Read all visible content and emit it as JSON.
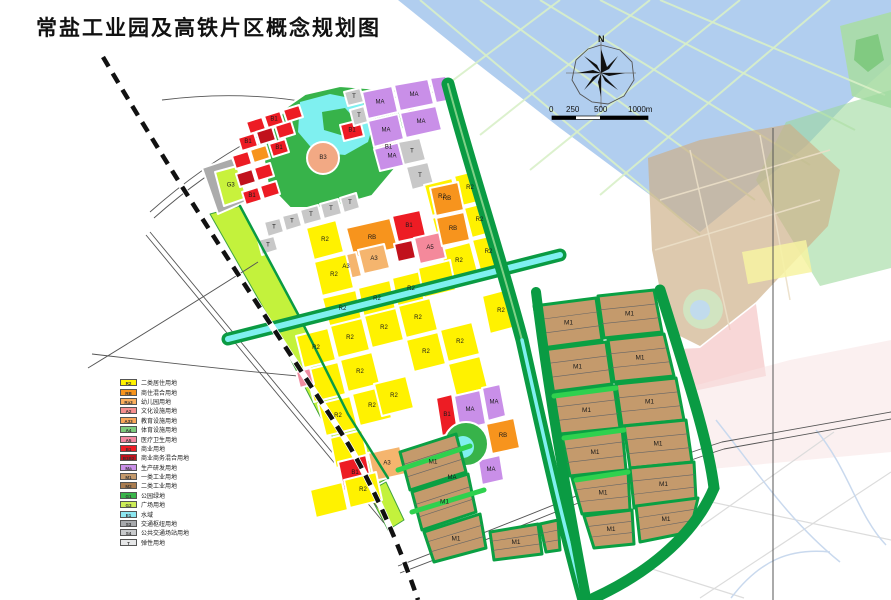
{
  "title": "常盐工业园及高铁片区概念规划图",
  "compass": {
    "label": "N"
  },
  "scale_bar": {
    "labels": [
      "0",
      "250",
      "500",
      "1000m"
    ]
  },
  "legend": {
    "items": [
      {
        "code": "R2",
        "color": "#FFF200",
        "label": "二类居住用地"
      },
      {
        "code": "RB",
        "color": "#F7941D",
        "label": "商住混合用地"
      },
      {
        "code": "Ra3",
        "color": "#FBAF5D",
        "label": "幼儿园用地"
      },
      {
        "code": "A2",
        "color": "#F68E8E",
        "label": "文化设施用地"
      },
      {
        "code": "A33",
        "color": "#F9A65A",
        "label": "教育设施用地"
      },
      {
        "code": "A4",
        "color": "#7CCB7C",
        "label": "体育设施用地"
      },
      {
        "code": "A5",
        "color": "#F287A0",
        "label": "医疗卫生用地"
      },
      {
        "code": "B1",
        "color": "#ED1C24",
        "label": "商业用地"
      },
      {
        "code": "B1B2",
        "color": "#C1121C",
        "label": "商业商务混合用地"
      },
      {
        "code": "Ma",
        "color": "#C98FE8",
        "label": "生产研发用地"
      },
      {
        "code": "M1",
        "color": "#C49A6C",
        "label": "一类工业用地"
      },
      {
        "code": "M2",
        "color": "#A97C50",
        "label": "二类工业用地"
      },
      {
        "code": "G1",
        "color": "#39B54A",
        "label": "公园绿地"
      },
      {
        "code": "G3",
        "color": "#CDED57",
        "label": "广场用地"
      },
      {
        "code": "E1",
        "color": "#8CE6F0",
        "label": "水域"
      },
      {
        "code": "S3",
        "color": "#A7A9AC",
        "label": "交通枢纽用地"
      },
      {
        "code": "S4",
        "color": "#C8CACC",
        "label": "公共交通场站用地"
      },
      {
        "code": "T",
        "color": "#E6E7E8",
        "label": "弹性用地"
      }
    ]
  },
  "map": {
    "context": [
      {
        "p": "398,0 891,0 891,64 846,104 806,146 700,232 560,128 470,58",
        "f": "#A3C6EC",
        "o": 0.85
      },
      {
        "p": "840,26 891,12 891,108 852,96",
        "f": "#AADDA5",
        "o": 0.9
      },
      {
        "p": "856,40 878,34 884,60 868,72 854,60",
        "f": "#7CC87C",
        "o": 0.9,
        "s": "none"
      },
      {
        "d": "M420,0 L700,235",
        "st": "#D8EFC8",
        "w": 2,
        "o": 0.9
      },
      {
        "d": "M480,0 L755,200",
        "st": "#D8EFC8",
        "w": 2,
        "o": 0.9
      },
      {
        "d": "M540,0 L810,165",
        "st": "#D8EFC8",
        "w": 2,
        "o": 0.9
      },
      {
        "d": "M600,0 L855,130",
        "st": "#D8EFC8",
        "w": 2,
        "o": 0.9
      },
      {
        "d": "M660,0 L885,95",
        "st": "#D8EFC8",
        "w": 2,
        "o": 0.9
      },
      {
        "d": "M560,0 L440,90",
        "st": "#D8EFC8",
        "w": 2,
        "o": 0.9
      },
      {
        "d": "M650,0 L480,135",
        "st": "#D8EFC8",
        "w": 2,
        "o": 0.9
      },
      {
        "d": "M740,0 L530,170",
        "st": "#D8EFC8",
        "w": 2,
        "o": 0.9
      },
      {
        "d": "M830,0 L600,195",
        "st": "#D8EFC8",
        "w": 2,
        "o": 0.9
      },
      {
        "p": "786,122 891,90 891,268 820,286 756,180",
        "f": "#9CD89C",
        "o": 0.6
      },
      {
        "p": "648,158 700,140 790,124 840,170 828,226 756,302 700,346 668,330 652,250",
        "f": "#CDAF87",
        "o": 0.68
      },
      {
        "d": "M660,200 L830,150",
        "st": "#EBDFC8",
        "w": 1.5,
        "o": 0.9
      },
      {
        "d": "M655,250 L820,200",
        "st": "#EBDFC8",
        "w": 1.5,
        "o": 0.9
      },
      {
        "d": "M690,150 L730,330",
        "st": "#EBDFC8",
        "w": 1.5,
        "o": 0.9
      },
      {
        "d": "M760,135 L790,300",
        "st": "#EBDFC8",
        "w": 1.5,
        "o": 0.9
      },
      {
        "p": "656,350 700,348 756,304 766,376 660,398",
        "f": "#F3BCBC",
        "o": 0.6
      },
      {
        "c": [
          703,
          309,
          20
        ],
        "f": "#CFE9C4",
        "o": 0.85
      },
      {
        "c": [
          700,
          310,
          10
        ],
        "f": "#BFD9F2",
        "o": 0.9
      },
      {
        "p": "742,252 806,240 812,272 748,284",
        "f": "#F7F3A2",
        "o": 0.85
      },
      {
        "p": "656,396 790,360 891,340 891,452 700,470",
        "f": "#F8E4E4",
        "o": 0.55
      },
      {
        "d": "M560,470 L891,540",
        "st": "#DCDCDC",
        "w": 1.2
      },
      {
        "d": "M600,598 L834,432",
        "st": "#DCDCDC",
        "w": 1.2
      },
      {
        "d": "M700,598 L891,472",
        "st": "#DCDCDC",
        "w": 1.2
      },
      {
        "d": "M560,540 L744,598",
        "st": "#DCDCDC",
        "w": 1.2
      },
      {
        "d": "M716,420 C756,470 788,520 840,562",
        "st": "#C9D9EE",
        "w": 1.5
      },
      {
        "d": "M816,430 C848,468 858,516 886,545",
        "st": "#C9D9EE",
        "w": 1.5
      },
      {
        "d": "M731,598 C760,560 790,548 830,552",
        "st": "#C9D9EE",
        "w": 1.5
      },
      {
        "d": "M773,128 L773,600",
        "st": "#555",
        "w": 1
      }
    ],
    "base": [
      {
        "p": "210,214 244,148 286,96 344,82 452,80 478,180 508,300 660,288 690,380 714,480 700,530 640,572 590,600 396,600 350,466 298,338 252,260",
        "f": "#FFFFFF"
      },
      {
        "p": "210,214 240,206 300,318 348,414 388,478 366,490 322,420 268,316",
        "f": "#C3F23C",
        "s": "#3FA33F"
      },
      {
        "p": "368,492 386,482 404,520 388,530",
        "f": "#C3F23C",
        "s": "#3FA33F"
      }
    ],
    "roads_outside": [
      {
        "d": "M150,212 C240,132 330,96 432,86"
      },
      {
        "d": "M154,218 C244,138 334,102 434,92"
      },
      {
        "d": "M162,100 C240,90 310,98 372,118"
      },
      {
        "d": "M88,368 C150,330 205,296 258,262"
      },
      {
        "d": "M150,232 L388,520"
      },
      {
        "d": "M146,235 L384,523"
      },
      {
        "d": "M92,354 C160,362 230,370 298,376"
      },
      {
        "d": "M398,566 C520,520 640,468 722,442 L891,412"
      },
      {
        "d": "M400,573 C522,527 642,475 724,449 L891,419"
      }
    ],
    "zones": [
      {
        "p": "262,148 285,108 305,94 340,86 392,90 404,125 398,165 372,196 330,208 290,208 268,185",
        "f": "#37B34A"
      },
      {
        "p": "300,102 330,94 360,100 375,118 368,142 345,155 315,152 298,132",
        "f": "#7FF0F0",
        "s": "none"
      },
      {
        "p": "322,112 345,108 358,122 344,136 324,130",
        "f": "#37B34A",
        "s": "none"
      },
      {
        "p": "202,168 232,158 250,200 218,214",
        "f": "#ABABAB"
      },
      {
        "p": "215,172 237,166 247,198 224,206",
        "f": "#C8F23C",
        "l": "G3"
      },
      {
        "p": "246,122 262,117 266,129 250,134",
        "f": "#ED1C24"
      },
      {
        "p": "264,116 280,111 284,123 268,128",
        "f": "#ED1C24",
        "l": "B1"
      },
      {
        "p": "283,110 299,105 303,117 287,122",
        "f": "#ED1C24"
      },
      {
        "p": "238,138 254,133 258,146 242,151",
        "f": "#ED1C24",
        "l": "B1"
      },
      {
        "p": "256,132 272,127 276,140 260,145",
        "f": "#C1121C"
      },
      {
        "p": "275,126 291,121 295,134 279,139",
        "f": "#ED1C24"
      },
      {
        "p": "232,156 248,151 252,164 236,169",
        "f": "#ED1C24"
      },
      {
        "p": "250,150 266,145 270,158 254,163",
        "f": "#F7941D"
      },
      {
        "p": "269,144 285,139 289,152 273,157",
        "f": "#ED1C24",
        "l": "B1"
      },
      {
        "p": "236,174 252,169 256,182 240,187",
        "f": "#C1121C"
      },
      {
        "p": "254,168 270,163 274,176 258,181",
        "f": "#ED1C24"
      },
      {
        "p": "242,192 258,187 262,200 246,205",
        "f": "#ED1C24",
        "l": "B1"
      },
      {
        "p": "260,186 276,181 280,194 264,199",
        "f": "#ED1C24"
      },
      {
        "p": "340,125 360,120 364,136 344,141",
        "f": "#ED1C24",
        "l": "B1"
      },
      {
        "p": "404,97 420,93 424,107 408,112",
        "f": "#ED1C24"
      },
      {
        "p": "376,140 396,135 401,155 381,160",
        "f": "#ED1C24",
        "l": "B1"
      },
      {
        "p": "362,92 392,86 398,112 368,119",
        "f": "#C98FE8",
        "l": "MA"
      },
      {
        "p": "394,85 428,79 434,104 400,111",
        "f": "#C98FE8",
        "l": "MA"
      },
      {
        "p": "368,121 398,114 404,139 374,147",
        "f": "#C98FE8",
        "l": "MA"
      },
      {
        "p": "400,113 436,106 442,130 406,138",
        "f": "#C98FE8",
        "l": "MA"
      },
      {
        "p": "430,78 446,76 452,100 436,103",
        "f": "#C98FE8"
      },
      {
        "p": "374,149 404,141 410,164 380,171",
        "f": "#C98FE8",
        "l": "MA"
      },
      {
        "p": "344,92 360,88 364,102 348,106",
        "f": "#C8C8C8",
        "l": "T"
      },
      {
        "p": "350,110 364,106 368,122 354,126",
        "f": "#C8C8C8",
        "l": "T"
      },
      {
        "p": "398,142 420,138 426,160 404,165",
        "f": "#C8C8C8",
        "l": "T"
      },
      {
        "p": "406,167 428,162 434,184 412,190",
        "f": "#C8C8C8",
        "l": "T"
      },
      {
        "p": "300,210 318,205 322,220 304,225",
        "f": "#C8C8C8",
        "l": "T"
      },
      {
        "p": "320,204 338,199 342,214 324,219",
        "f": "#C8C8C8",
        "l": "T"
      },
      {
        "p": "282,216 298,212 302,226 286,231",
        "f": "#C8C8C8",
        "l": "T"
      },
      {
        "p": "264,222 280,218 284,232 268,237",
        "f": "#C8C8C8",
        "l": "T"
      },
      {
        "p": "340,198 356,193 360,208 344,213",
        "f": "#C8C8C8",
        "l": "T"
      },
      {
        "p": "258,240 274,236 278,250 262,255",
        "f": "#C8C8C8",
        "l": "T"
      },
      {
        "c": [
          323,
          158,
          16
        ],
        "f": "#F2A984",
        "l": "B3"
      },
      {
        "p": "424,185 452,178 460,208 432,216",
        "f": "#FFF200",
        "l": "R2"
      },
      {
        "p": "454,176 478,170 486,200 462,206",
        "f": "#FFF200",
        "l": "R2"
      },
      {
        "p": "432,218 462,210 470,240 440,248",
        "f": "#FFF200"
      },
      {
        "p": "464,208 488,202 494,232 472,238",
        "f": "#FFF200",
        "l": "R2"
      },
      {
        "p": "440,250 470,242 478,272 448,280",
        "f": "#FFF200",
        "l": "R2"
      },
      {
        "p": "472,240 498,234 504,264 480,270",
        "f": "#FFF200",
        "l": "R2"
      },
      {
        "p": "482,296 512,288 520,326 490,334",
        "f": "#FFF200",
        "l": "R2"
      },
      {
        "p": "306,228 336,220 344,252 314,260",
        "f": "#FFF200",
        "l": "R2"
      },
      {
        "p": "346,228 390,218 398,248 354,258",
        "f": "#F7941D",
        "l": "RB"
      },
      {
        "p": "330,258 356,252 362,276 336,282",
        "f": "#F5B56E",
        "l": "A3"
      },
      {
        "p": "358,250 384,244 390,268 364,274",
        "f": "#F5B56E",
        "l": "A3"
      },
      {
        "p": "392,216 420,210 426,236 398,242",
        "f": "#ED1C24",
        "l": "B1"
      },
      {
        "p": "394,244 412,240 416,258 398,262",
        "f": "#C1121C"
      },
      {
        "p": "414,238 440,232 446,258 420,264",
        "f": "#F4899B",
        "l": "A5"
      },
      {
        "p": "430,188 458,182 464,210 436,216",
        "f": "#F7941D",
        "l": "RB"
      },
      {
        "p": "436,218 464,212 470,240 442,246",
        "f": "#F7941D",
        "l": "RB"
      },
      {
        "p": "314,262 346,254 354,288 322,296",
        "f": "#FFF200",
        "l": "R2"
      },
      {
        "p": "322,298 356,290 362,320 330,328",
        "f": "#FFF200",
        "l": "R2"
      },
      {
        "p": "358,288 390,280 396,310 364,318",
        "f": "#FFF200",
        "l": "R2"
      },
      {
        "p": "392,278 424,270 430,300 398,308",
        "f": "#FFF200",
        "l": "R2"
      },
      {
        "p": "418,268 450,260 456,290 424,298",
        "f": "#FFF200"
      },
      {
        "p": "296,336 328,328 336,360 304,368",
        "f": "#FFF200",
        "l": "R2"
      },
      {
        "p": "330,326 362,318 370,350 338,358",
        "f": "#FFF200",
        "l": "R2"
      },
      {
        "p": "306,370 338,362 346,394 314,402",
        "f": "#FFF200"
      },
      {
        "p": "340,360 372,352 380,384 348,392",
        "f": "#FFF200",
        "l": "R2"
      },
      {
        "p": "318,404 350,396 358,428 326,436",
        "f": "#FFF200",
        "l": "R2"
      },
      {
        "p": "352,394 384,386 392,418 360,426",
        "f": "#FFF200",
        "l": "R2"
      },
      {
        "p": "330,438 362,430 368,460 336,468",
        "f": "#FFF200"
      },
      {
        "p": "364,316 396,308 404,340 372,348",
        "f": "#FFF200",
        "l": "R2"
      },
      {
        "p": "398,306 430,298 438,330 406,338",
        "f": "#FFF200",
        "l": "R2"
      },
      {
        "p": "406,340 438,332 446,364 414,372",
        "f": "#FFF200",
        "l": "R2"
      },
      {
        "p": "440,330 472,322 480,354 448,362",
        "f": "#FFF200",
        "l": "R2"
      },
      {
        "p": "448,364 480,356 488,388 456,396",
        "f": "#FFF200"
      },
      {
        "p": "296,372 310,368 314,384 300,388",
        "f": "#F08CA0"
      },
      {
        "p": "374,384 406,376 414,408 382,416",
        "f": "#FFF200",
        "l": "R2"
      },
      {
        "p": "338,462 366,455 372,484 344,491",
        "f": "#ED1C24",
        "l": "B1"
      },
      {
        "p": "368,453 400,446 406,474 374,481",
        "f": "#F5B56E",
        "l": "A3"
      },
      {
        "p": "310,490 342,482 348,510 316,518",
        "f": "#FFF200"
      },
      {
        "p": "344,480 376,472 382,500 350,508",
        "f": "#FFF200",
        "l": "R2"
      },
      {
        "p": "436,398 452,394 458,432 442,436",
        "f": "#ED1C24",
        "l": "B1"
      },
      {
        "p": "454,396 480,390 486,424 460,430",
        "f": "#C98FE8",
        "l": "MA"
      },
      {
        "p": "482,388 500,384 506,416 488,421",
        "f": "#C98FE8",
        "l": "MA"
      },
      {
        "p": "486,424 514,418 520,448 492,454",
        "f": "#F7941D",
        "l": "RB"
      },
      {
        "p": "438,468 462,462 466,488 442,493",
        "f": "#C98FE8",
        "l": "MA"
      },
      {
        "p": "478,460 500,455 504,480 482,485",
        "f": "#C98FE8",
        "l": "MA"
      },
      {
        "c": [
          466,
          444,
          22
        ],
        "f": "#37B34A"
      },
      {
        "c": [
          463,
          447,
          11
        ],
        "f": "#7FF0F0",
        "s": "none"
      },
      {
        "p": "400,452 456,434 466,472 410,490",
        "f": "#C49A6C",
        "l": "M1",
        "h": 1,
        "sw": 3,
        "s": "#0AA043"
      },
      {
        "p": "412,492 468,474 476,512 422,530",
        "f": "#C49A6C",
        "l": "M1",
        "h": 1,
        "sw": 3,
        "s": "#0AA043"
      },
      {
        "p": "424,532 480,514 486,548 434,562",
        "f": "#C49A6C",
        "l": "M1",
        "h": 1,
        "sw": 3,
        "s": "#0AA043"
      },
      {
        "p": "490,532 538,524 542,554 494,560",
        "f": "#C49A6C",
        "l": "M1",
        "h": 1,
        "sw": 3,
        "s": "#0AA043"
      },
      {
        "p": "540,524 558,520 560,550 546,552",
        "f": "#C49A6C",
        "h": 1,
        "sw": 3,
        "s": "#0AA043"
      },
      {
        "p": "534,306 596,298 602,340 542,348",
        "f": "#C49A6C",
        "l": "M1",
        "h": 1,
        "sw": 3,
        "s": "#0AA043"
      },
      {
        "p": "598,296 654,290 662,332 604,338",
        "f": "#C49A6C",
        "l": "M1",
        "h": 1,
        "sw": 3,
        "s": "#0AA043"
      },
      {
        "p": "542,350 606,342 612,384 550,392",
        "f": "#C49A6C",
        "l": "M1",
        "h": 1,
        "sw": 3,
        "s": "#0AA043"
      },
      {
        "p": "608,340 664,334 674,376 614,382",
        "f": "#C49A6C",
        "l": "M1",
        "h": 1,
        "sw": 3,
        "s": "#0AA043"
      },
      {
        "p": "552,394 614,386 620,428 560,434",
        "f": "#C49A6C",
        "l": "M1",
        "h": 1,
        "sw": 3,
        "s": "#0AA043"
      },
      {
        "p": "616,384 676,378 684,420 622,426",
        "f": "#C49A6C",
        "l": "M1",
        "h": 1,
        "sw": 3,
        "s": "#0AA043"
      },
      {
        "p": "562,436 622,428 626,470 570,476",
        "f": "#C49A6C",
        "l": "M1",
        "h": 1,
        "sw": 3,
        "s": "#0AA043"
      },
      {
        "p": "624,426 686,420 692,462 630,468",
        "f": "#C49A6C",
        "l": "M1",
        "h": 1,
        "sw": 3,
        "s": "#0AA043"
      },
      {
        "p": "572,478 628,470 630,510 582,514",
        "f": "#C49A6C",
        "l": "M1",
        "h": 1,
        "sw": 3,
        "s": "#0AA043"
      },
      {
        "p": "630,468 694,462 696,500 634,508",
        "f": "#C49A6C",
        "l": "M1",
        "h": 1,
        "sw": 3,
        "s": "#0AA043"
      },
      {
        "p": "584,516 632,510 634,544 594,548",
        "f": "#C49A6C",
        "l": "M1",
        "h": 1,
        "sw": 3,
        "s": "#0AA043"
      },
      {
        "p": "636,506 698,498 690,532 640,542",
        "f": "#C49A6C",
        "l": "M1",
        "h": 1,
        "sw": 3,
        "s": "#0AA043"
      }
    ],
    "belts": [
      {
        "d": "M240,206 L300,318 L348,414 L388,478",
        "w": 2.5,
        "c": "#0A9B43"
      },
      {
        "d": "M228,339 L560,255",
        "w": 13,
        "c": "#0A9B43"
      },
      {
        "d": "M228,339 L560,255",
        "w": 6,
        "c": "#7FF0F0"
      },
      {
        "d": "M448,84 C468,160 498,250 522,340 C542,430 562,520 584,600",
        "w": 13,
        "c": "#0A9B43"
      },
      {
        "d": "M448,84 C468,160 498,250 522,340",
        "w": 2,
        "c": "#7ED087"
      },
      {
        "d": "M522,340 C542,430 562,520 584,600",
        "w": 3.5,
        "c": "#7FF0F0"
      },
      {
        "d": "M536,292 C548,390 564,480 586,598",
        "w": 10,
        "c": "#0A9B43"
      },
      {
        "d": "M660,290 C688,380 708,440 714,488 C692,540 642,576 594,598",
        "w": 11,
        "c": "#0A9B43"
      },
      {
        "d": "M554,396 L616,388",
        "w": 5,
        "c": "#2FD14E"
      },
      {
        "d": "M564,438 L624,430",
        "w": 5,
        "c": "#2FD14E"
      },
      {
        "d": "M576,480 L628,472",
        "w": 5,
        "c": "#2FD14E"
      },
      {
        "d": "M398,470 L470,446",
        "w": 5,
        "c": "#2FD14E"
      },
      {
        "d": "M412,512 L484,490",
        "w": 5,
        "c": "#2FD14E"
      }
    ],
    "railway": {
      "d": "M103,57 C190,205 285,345 342,434 C370,478 400,546 418,600"
    }
  }
}
